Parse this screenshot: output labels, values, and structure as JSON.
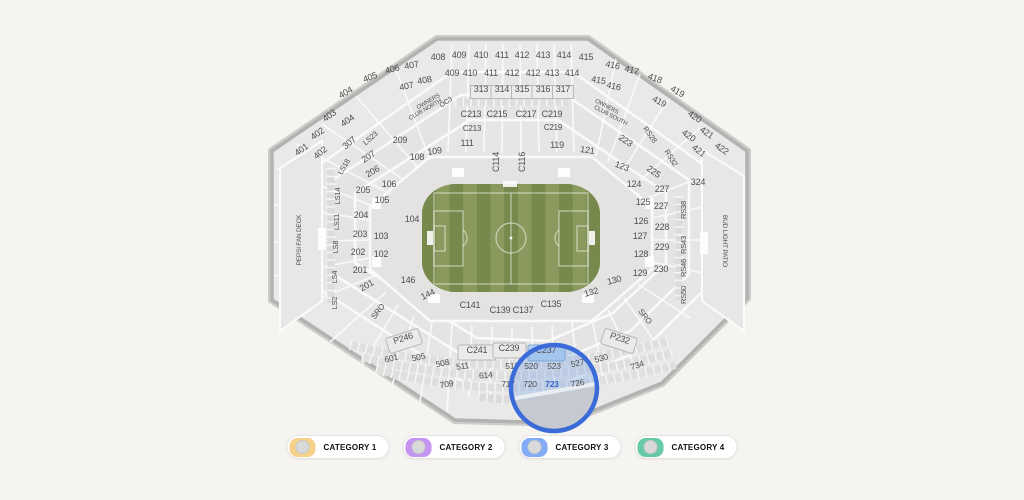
{
  "stadium": {
    "title": "stadium-seating-map",
    "field_type": "soccer",
    "selected_section": "723",
    "magnifier": {
      "cx": 554,
      "cy": 388,
      "r": 43,
      "color": "#3a6bd8"
    },
    "labels": [
      {
        "t": "401",
        "x": 303,
        "y": 152,
        "r": -35
      },
      {
        "t": "402",
        "x": 319,
        "y": 136,
        "r": -35
      },
      {
        "t": "403",
        "x": 331,
        "y": 118,
        "r": -35
      },
      {
        "t": "404",
        "x": 347,
        "y": 95,
        "r": -30
      },
      {
        "t": "405",
        "x": 371,
        "y": 80,
        "r": -20
      },
      {
        "t": "406",
        "x": 393,
        "y": 72,
        "r": -15
      },
      {
        "t": "407",
        "x": 412,
        "y": 68,
        "r": -10
      },
      {
        "t": "408",
        "x": 438,
        "y": 60
      },
      {
        "t": "409",
        "x": 459,
        "y": 58
      },
      {
        "t": "410",
        "x": 481,
        "y": 58
      },
      {
        "t": "411",
        "x": 502,
        "y": 58
      },
      {
        "t": "412",
        "x": 522,
        "y": 58
      },
      {
        "t": "413",
        "x": 543,
        "y": 58
      },
      {
        "t": "414",
        "x": 564,
        "y": 58
      },
      {
        "t": "415",
        "x": 586,
        "y": 60
      },
      {
        "t": "416",
        "x": 612,
        "y": 68,
        "r": 12
      },
      {
        "t": "417",
        "x": 631,
        "y": 73,
        "r": 15
      },
      {
        "t": "418",
        "x": 654,
        "y": 81,
        "r": 20
      },
      {
        "t": "419",
        "x": 676,
        "y": 94,
        "r": 30
      },
      {
        "t": "420",
        "x": 693,
        "y": 119,
        "r": 35
      },
      {
        "t": "421",
        "x": 705,
        "y": 135,
        "r": 35
      },
      {
        "t": "422",
        "x": 720,
        "y": 151,
        "r": 35
      },
      {
        "t": "402",
        "x": 322,
        "y": 155,
        "r": -40
      },
      {
        "t": "404",
        "x": 349,
        "y": 123,
        "r": -35
      },
      {
        "t": "407",
        "x": 407,
        "y": 89,
        "r": -12
      },
      {
        "t": "408",
        "x": 425,
        "y": 83,
        "r": -10
      },
      {
        "t": "409",
        "x": 452,
        "y": 76
      },
      {
        "t": "410",
        "x": 470,
        "y": 76
      },
      {
        "t": "411",
        "x": 491,
        "y": 76
      },
      {
        "t": "412",
        "x": 512,
        "y": 76
      },
      {
        "t": "412",
        "x": 533,
        "y": 76
      },
      {
        "t": "413",
        "x": 552,
        "y": 76
      },
      {
        "t": "414",
        "x": 572,
        "y": 76
      },
      {
        "t": "415",
        "x": 598,
        "y": 83,
        "r": 10
      },
      {
        "t": "416",
        "x": 613,
        "y": 89,
        "r": 12
      },
      {
        "t": "419",
        "x": 658,
        "y": 104,
        "r": 28
      },
      {
        "t": "420",
        "x": 687,
        "y": 138,
        "r": 35
      },
      {
        "t": "421",
        "x": 697,
        "y": 153,
        "r": 38
      },
      {
        "t": "307",
        "x": 351,
        "y": 145,
        "r": -40
      },
      {
        "t": "313",
        "x": 481,
        "y": 92
      },
      {
        "t": "314",
        "x": 502,
        "y": 92
      },
      {
        "t": "315",
        "x": 522,
        "y": 92
      },
      {
        "t": "316",
        "x": 543,
        "y": 92
      },
      {
        "t": "317",
        "x": 563,
        "y": 92
      },
      {
        "t": "324",
        "x": 698,
        "y": 185
      },
      {
        "t": "C213",
        "x": 471,
        "y": 117
      },
      {
        "t": "C215",
        "x": 497,
        "y": 117
      },
      {
        "t": "C217",
        "x": 526,
        "y": 117
      },
      {
        "t": "C219",
        "x": 552,
        "y": 117
      },
      {
        "t": "C213",
        "x": 472,
        "y": 131,
        "s": 8
      },
      {
        "t": "C219",
        "x": 553,
        "y": 130,
        "s": 8
      },
      {
        "t": "OC3",
        "x": 447,
        "y": 104,
        "r": -33,
        "s": 7
      },
      {
        "t": "OWNERS",
        "x": 429,
        "y": 103,
        "r": -30,
        "s": 6
      },
      {
        "t": "CLUB NORTH",
        "x": 426,
        "y": 111,
        "r": -30,
        "s": 6
      },
      {
        "t": "OWNERS",
        "x": 606,
        "y": 108,
        "r": 28,
        "s": 6
      },
      {
        "t": "CLUB SOUTH",
        "x": 610,
        "y": 117,
        "r": 28,
        "s": 6
      },
      {
        "t": "LS23",
        "x": 372,
        "y": 140,
        "r": -42,
        "s": 7.5
      },
      {
        "t": "LS18",
        "x": 346,
        "y": 168,
        "r": -60,
        "s": 7.5
      },
      {
        "t": "LS14",
        "x": 340,
        "y": 196,
        "r": -90,
        "s": 7.5
      },
      {
        "t": "LS11",
        "x": 339,
        "y": 222,
        "r": -90,
        "s": 7.5
      },
      {
        "t": "LS8",
        "x": 338,
        "y": 247,
        "r": -90,
        "s": 7.5
      },
      {
        "t": "LS4",
        "x": 337,
        "y": 277,
        "r": -90,
        "s": 7.5
      },
      {
        "t": "LS2",
        "x": 337,
        "y": 303,
        "r": -90,
        "s": 7.5
      },
      {
        "t": "RS28",
        "x": 648,
        "y": 136,
        "r": 55,
        "s": 7.5
      },
      {
        "t": "RS32",
        "x": 669,
        "y": 159,
        "r": 58,
        "s": 7.5
      },
      {
        "t": "RS38",
        "x": 686,
        "y": 210,
        "r": -90,
        "s": 7.5
      },
      {
        "t": "RS43",
        "x": 686,
        "y": 245,
        "r": -90,
        "s": 7.5
      },
      {
        "t": "RS46",
        "x": 686,
        "y": 268,
        "r": -90,
        "s": 7.5
      },
      {
        "t": "RS50",
        "x": 686,
        "y": 295,
        "r": -90,
        "s": 7.5
      },
      {
        "t": "PEPSI FAN DECK",
        "x": 301,
        "y": 240,
        "r": -90,
        "s": 6.5
      },
      {
        "t": "BUD LIGHT PATIO",
        "x": 723,
        "y": 241,
        "r": 90,
        "s": 6.5
      },
      {
        "t": "209",
        "x": 400,
        "y": 143
      },
      {
        "t": "207",
        "x": 370,
        "y": 159,
        "r": -35
      },
      {
        "t": "206",
        "x": 374,
        "y": 174,
        "r": -30
      },
      {
        "t": "205",
        "x": 363,
        "y": 193
      },
      {
        "t": "204",
        "x": 361,
        "y": 218
      },
      {
        "t": "203",
        "x": 360,
        "y": 237
      },
      {
        "t": "202",
        "x": 358,
        "y": 255
      },
      {
        "t": "201",
        "x": 360,
        "y": 273
      },
      {
        "t": "201",
        "x": 368,
        "y": 288,
        "r": -30
      },
      {
        "t": "223",
        "x": 624,
        "y": 143,
        "r": 35
      },
      {
        "t": "225",
        "x": 652,
        "y": 174,
        "r": 35
      },
      {
        "t": "227",
        "x": 662,
        "y": 192
      },
      {
        "t": "227",
        "x": 661,
        "y": 209
      },
      {
        "t": "228",
        "x": 662,
        "y": 230
      },
      {
        "t": "229",
        "x": 662,
        "y": 250
      },
      {
        "t": "230",
        "x": 661,
        "y": 272
      },
      {
        "t": "102",
        "x": 381,
        "y": 257
      },
      {
        "t": "103",
        "x": 381,
        "y": 239
      },
      {
        "t": "104",
        "x": 412,
        "y": 222
      },
      {
        "t": "105",
        "x": 382,
        "y": 203
      },
      {
        "t": "106",
        "x": 389,
        "y": 187
      },
      {
        "t": "108",
        "x": 417,
        "y": 160
      },
      {
        "t": "109",
        "x": 435,
        "y": 154,
        "r": -8
      },
      {
        "t": "111",
        "x": 467,
        "y": 146
      },
      {
        "t": "119",
        "x": 557,
        "y": 148
      },
      {
        "t": "121",
        "x": 587,
        "y": 153,
        "r": 8
      },
      {
        "t": "123",
        "x": 621,
        "y": 169,
        "r": 20
      },
      {
        "t": "124",
        "x": 634,
        "y": 187
      },
      {
        "t": "125",
        "x": 643,
        "y": 205
      },
      {
        "t": "126",
        "x": 641,
        "y": 224
      },
      {
        "t": "127",
        "x": 640,
        "y": 239
      },
      {
        "t": "128",
        "x": 641,
        "y": 257
      },
      {
        "t": "129",
        "x": 640,
        "y": 276
      },
      {
        "t": "130",
        "x": 615,
        "y": 283,
        "r": -15
      },
      {
        "t": "132",
        "x": 592,
        "y": 295,
        "r": -15
      },
      {
        "t": "144",
        "x": 429,
        "y": 297,
        "r": -25
      },
      {
        "t": "146",
        "x": 408,
        "y": 283
      },
      {
        "t": "C114",
        "x": 499,
        "y": 162,
        "r": -90
      },
      {
        "t": "C116",
        "x": 525,
        "y": 162,
        "r": -90
      },
      {
        "t": "C135",
        "x": 551,
        "y": 307
      },
      {
        "t": "C137",
        "x": 523,
        "y": 313
      },
      {
        "t": "C139",
        "x": 500,
        "y": 313
      },
      {
        "t": "C141",
        "x": 470,
        "y": 308
      },
      {
        "t": "SRO",
        "x": 380,
        "y": 313,
        "r": -52,
        "s": 8
      },
      {
        "t": "SRO",
        "x": 643,
        "y": 318,
        "r": 52,
        "s": 8
      },
      {
        "t": "P246",
        "x": 404,
        "y": 341,
        "r": -18
      },
      {
        "t": "P232",
        "x": 619,
        "y": 341,
        "r": 18
      },
      {
        "t": "C241",
        "x": 477,
        "y": 353
      },
      {
        "t": "C239",
        "x": 509,
        "y": 351
      },
      {
        "t": "C237",
        "x": 546,
        "y": 353
      },
      {
        "t": "601",
        "x": 392,
        "y": 361,
        "r": -15,
        "s": 8.5
      },
      {
        "t": "505",
        "x": 419,
        "y": 360,
        "r": -12,
        "s": 8.5
      },
      {
        "t": "508",
        "x": 443,
        "y": 366,
        "r": -12,
        "s": 8.5
      },
      {
        "t": "511",
        "x": 463,
        "y": 369,
        "r": -8,
        "s": 8.5
      },
      {
        "t": "517",
        "x": 512,
        "y": 369,
        "s": 8.5
      },
      {
        "t": "520",
        "x": 531,
        "y": 369,
        "s": 8.5
      },
      {
        "t": "523",
        "x": 554,
        "y": 369,
        "s": 8.5
      },
      {
        "t": "527",
        "x": 578,
        "y": 366,
        "r": -12,
        "s": 8.5
      },
      {
        "t": "530",
        "x": 602,
        "y": 361,
        "r": -15,
        "s": 8.5
      },
      {
        "t": "734",
        "x": 638,
        "y": 368,
        "r": -18,
        "s": 8.5
      },
      {
        "t": "614",
        "x": 486,
        "y": 378,
        "r": -5,
        "s": 8.5
      },
      {
        "t": "709",
        "x": 447,
        "y": 387,
        "r": -10,
        "s": 8.5
      },
      {
        "t": "717",
        "x": 508,
        "y": 387,
        "s": 8.5
      },
      {
        "t": "720",
        "x": 530,
        "y": 387,
        "s": 8.5
      },
      {
        "t": "723",
        "x": 552,
        "y": 387,
        "s": 8.5,
        "b": true,
        "c": "#3566c8"
      },
      {
        "t": "726",
        "x": 578,
        "y": 386,
        "r": -10,
        "s": 8.5
      }
    ]
  },
  "legend": {
    "items": [
      {
        "label": "CATEGORY 1",
        "color": "#f6d189"
      },
      {
        "label": "CATEGORY 2",
        "color": "#c494f1"
      },
      {
        "label": "CATEGORY 3",
        "color": "#84acf6"
      },
      {
        "label": "CATEGORY 4",
        "color": "#67c9a5"
      }
    ]
  },
  "colors": {
    "background": "#f5f4f1",
    "field_light": "#8a9a5e",
    "field_dark": "#77894c",
    "wall": "#b3b2b1",
    "magnifier_border": "#3a6bd8",
    "highlight_fill": "#b9d3f1"
  }
}
